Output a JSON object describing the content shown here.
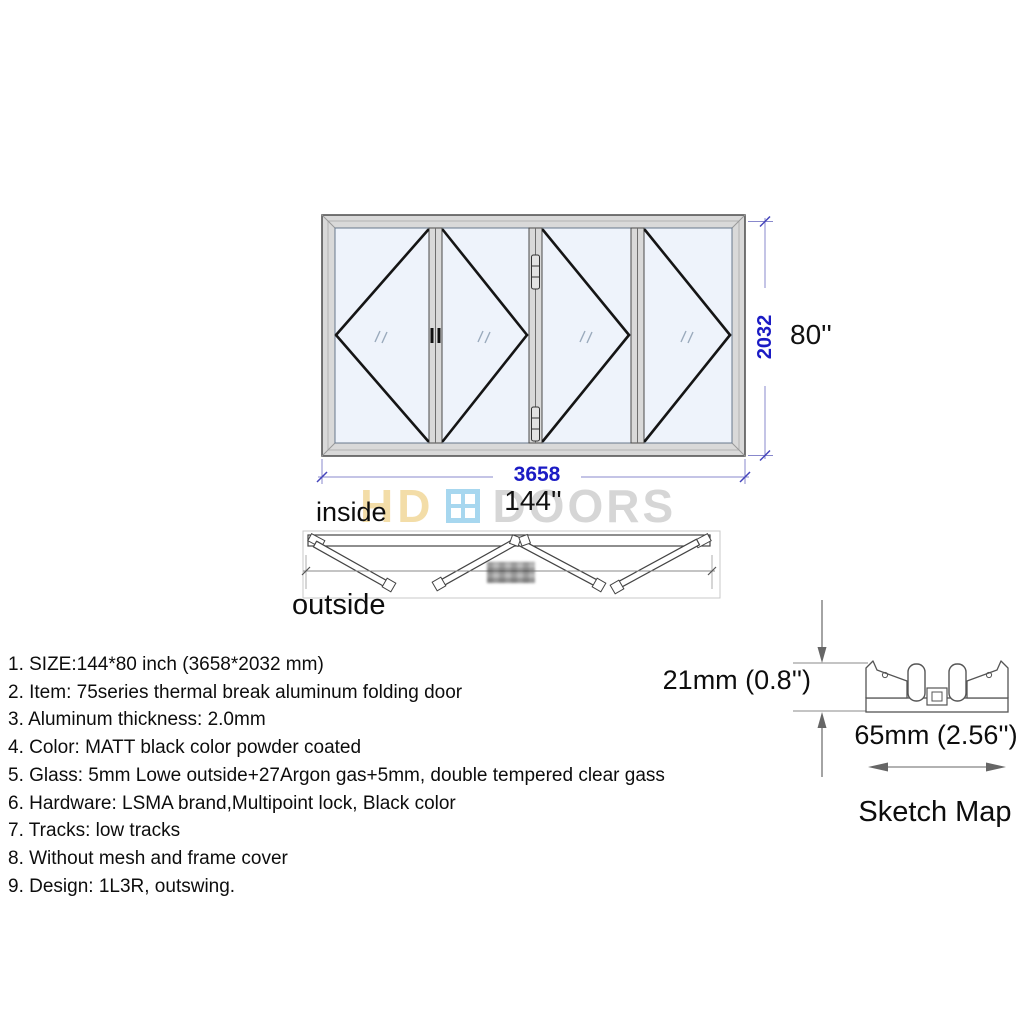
{
  "watermark": {
    "part1": "HD",
    "part2": "DOORS"
  },
  "elevation": {
    "width_mm": "3658",
    "width_in": "144''",
    "height_mm": "2032",
    "height_in": "80''"
  },
  "plan": {
    "inside": "inside",
    "outside": "outside"
  },
  "specs": {
    "items": [
      "1. SIZE:144*80 inch (3658*2032 mm)",
      "2. Item: 75series thermal break aluminum folding door",
      "3. Aluminum thickness: 2.0mm",
      "4. Color: MATT black color powder coated",
      "5. Glass: 5mm Lowe outside+27Argon gas+5mm, double tempered clear gass",
      "6. Hardware: LSMA brand,Multipoint lock, Black color",
      "7. Tracks: low tracks",
      "8. Without mesh and frame cover",
      "9. Design: 1L3R, outswing."
    ]
  },
  "sketch": {
    "height_label": "21mm (0.8'')",
    "width_label": "65mm (2.56'')",
    "caption": "Sketch Map"
  },
  "colors": {
    "dimension_label": "#1b1bc4",
    "dimension_line": "#8888cc",
    "frame_fill": "#d9d9d9",
    "glass_fill": "#eef3fb",
    "watermark_hd": "#f3dda8",
    "watermark_doors": "#d6d6d6",
    "watermark_icon_blue": "#a7d7ef",
    "ink": "#0d0d0d"
  }
}
